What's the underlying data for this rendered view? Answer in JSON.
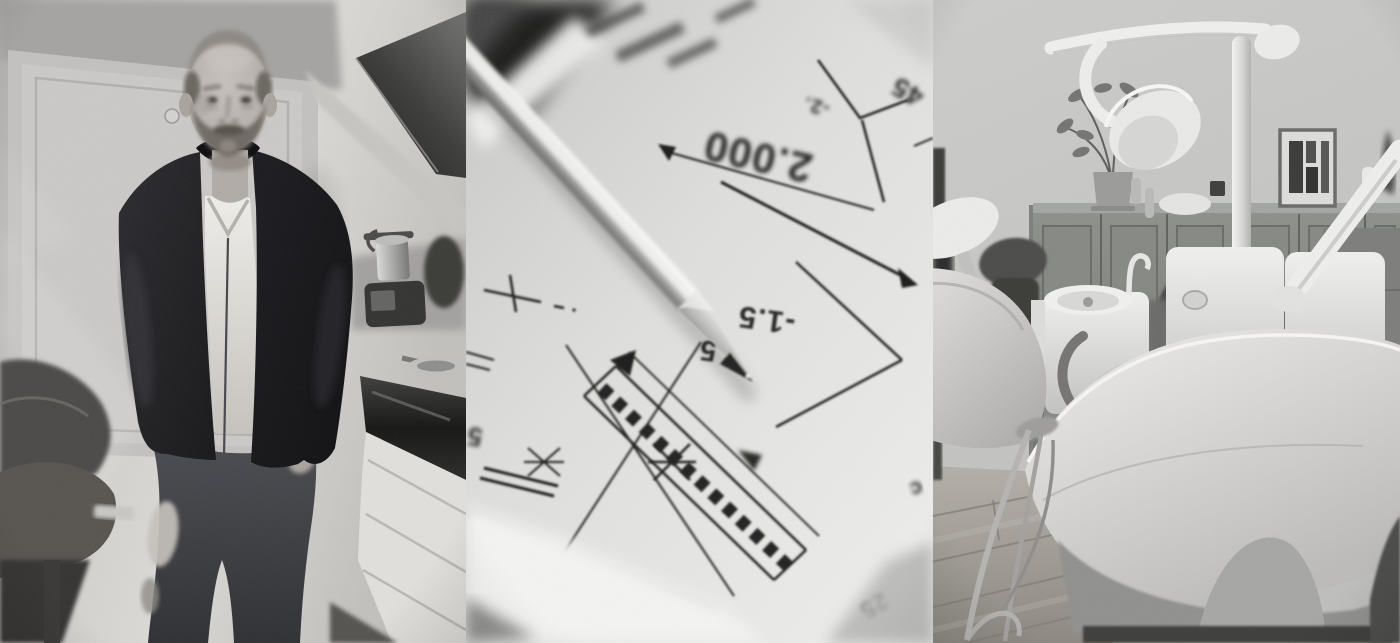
{
  "collage": {
    "style": "black-and-white photo triptych",
    "panels": [
      {
        "label": "man standing in kitchen"
      },
      {
        "label": "pencil on architectural blueprint"
      },
      {
        "label": "dental treatment room"
      }
    ]
  },
  "blueprint": {
    "dim_main": "2.000",
    "dim_secondary": "-2.",
    "dim_corner": "45",
    "dim_level": "-1.5",
    "dim_digit": "5",
    "dim_left_digit": "5",
    "dim_width": "25",
    "dim_letter": "c"
  },
  "palette": {
    "paper": "#dedddb",
    "ink": "#1d1d1b",
    "wall_gray": "#cac8c5",
    "jacket_black": "#1a1a1d",
    "cabinet_gray": "#83867f",
    "floor_gray": "#a5a19b"
  }
}
